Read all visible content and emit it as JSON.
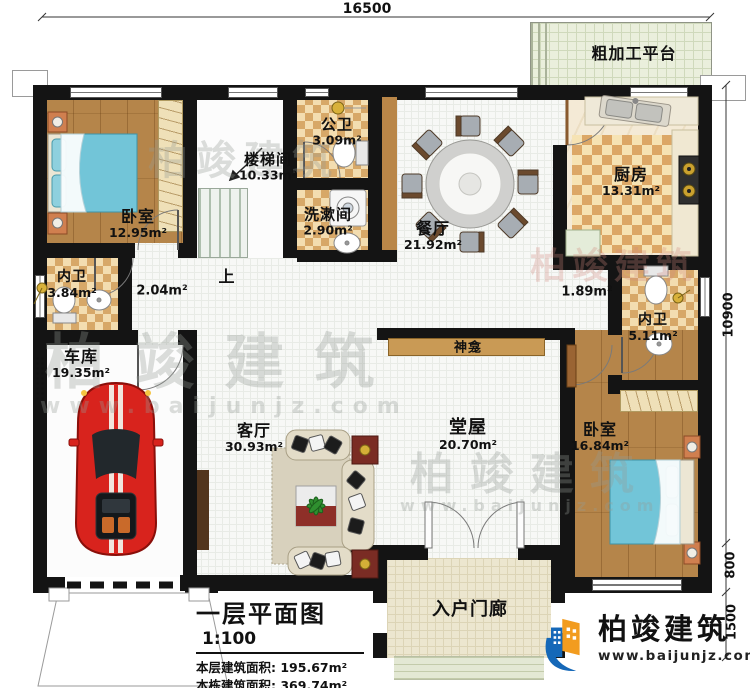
{
  "plan": {
    "dim_top": "16500",
    "dim_right_main": "10900",
    "dim_right_offset": "800",
    "dim_right_porch": "1500",
    "up_label": "上",
    "shrine": "神龛",
    "platform": "粗加工平台",
    "porch": "入户门廊",
    "rooms": {
      "bedroom1": {
        "name": "卧室",
        "area": "12.95m²"
      },
      "stairwell": {
        "name": "楼梯间",
        "area": "10.33m²"
      },
      "public_bath": {
        "name": "公卫",
        "area": "3.09m²"
      },
      "washroom": {
        "name": "洗漱间",
        "area": "2.90m²"
      },
      "dining": {
        "name": "餐厅",
        "area": "21.92m²"
      },
      "kitchen": {
        "name": "厨房",
        "area": "13.31m²"
      },
      "ensuite1": {
        "name": "内卫",
        "area": "3.84m²"
      },
      "corridor": {
        "area": "2.04m²"
      },
      "vestibule": {
        "area": "1.89m²"
      },
      "garage": {
        "name": "车库",
        "area": "19.35m²"
      },
      "living": {
        "name": "客厅",
        "area": "30.93m²"
      },
      "hall": {
        "name": "堂屋",
        "area": "20.70m²"
      },
      "ensuite2": {
        "name": "内卫",
        "area": "5.11m²"
      },
      "bedroom2": {
        "name": "卧室",
        "area": "16.84m²"
      }
    }
  },
  "title_block": {
    "title": "一层平面图",
    "scale": "1:100",
    "row1_label": "本层建筑面积:",
    "row1_value": "195.67m²",
    "row2_label": "本栋建筑面积:",
    "row2_value": "369.74m²",
    "row3_label": "占地面积:",
    "row3_value": "201.61m²",
    "row3b_label": "层高:",
    "row3b_value": "3.6m"
  },
  "logo": {
    "name": "柏竣建筑",
    "url": "www.baijunjz.com"
  },
  "watermark": {
    "text": "柏竣建筑",
    "url": "www.baijunjz.com"
  },
  "colors": {
    "wall": "#141414",
    "checker_dark": "#d7a868",
    "checker_light": "#f3ddb0",
    "wood_floor": "#b5854a",
    "bed_blue": "#72c5d8",
    "car_red": "#d8231d",
    "logo_blue": "#1568b8",
    "logo_orange": "#f29c1f",
    "shrine_band": "#c99a55"
  }
}
